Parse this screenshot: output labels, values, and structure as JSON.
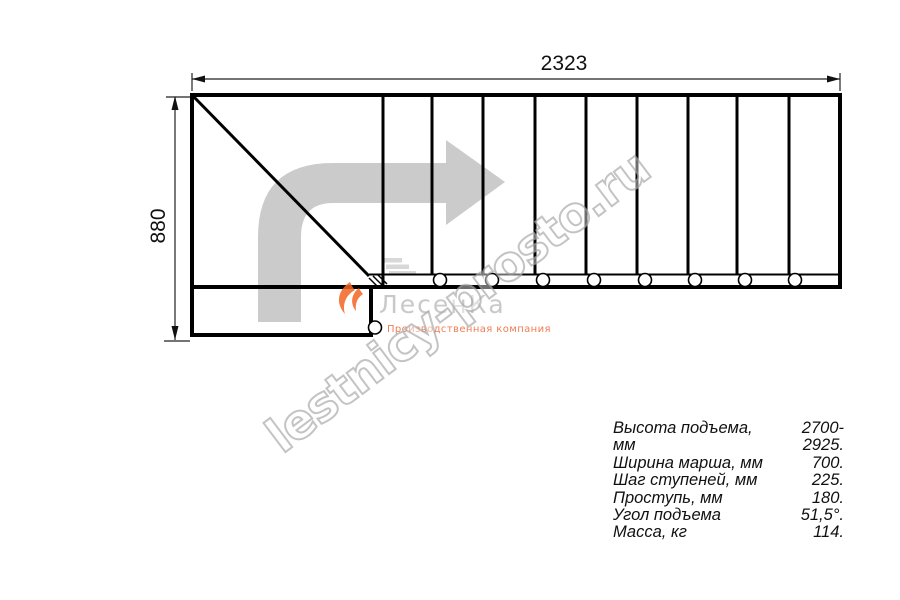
{
  "drawing": {
    "width_dim": "2323",
    "height_dim": "880"
  },
  "watermark": {
    "text": "lestnicy-prosto.ru"
  },
  "brand": {
    "name": "ЛесенКа",
    "subtitle": "Производственная компания"
  },
  "icons": {
    "direction_arrow": "turn-right-arrow",
    "brand_logo": "flame-swoosh",
    "stairs_glyph": "mini-stairs"
  },
  "colors": {
    "line": "#000000",
    "arrow_gray": "#c5c5c5",
    "watermark_gray": "#a8a8a8",
    "brand_gray": "#c9c9c9",
    "brand_orange": "#f26522"
  },
  "specs": {
    "rows": [
      {
        "label": "Высота подъема, мм",
        "value": "2700-2925."
      },
      {
        "label": "Ширина марша, мм",
        "value": "700."
      },
      {
        "label": "Шаг ступеней, мм",
        "value": "225."
      },
      {
        "label": "Проступь, мм",
        "value": "180."
      },
      {
        "label": "Угол подъема",
        "value": "51,5°."
      },
      {
        "label": "Масса, кг",
        "value": "114."
      }
    ]
  }
}
